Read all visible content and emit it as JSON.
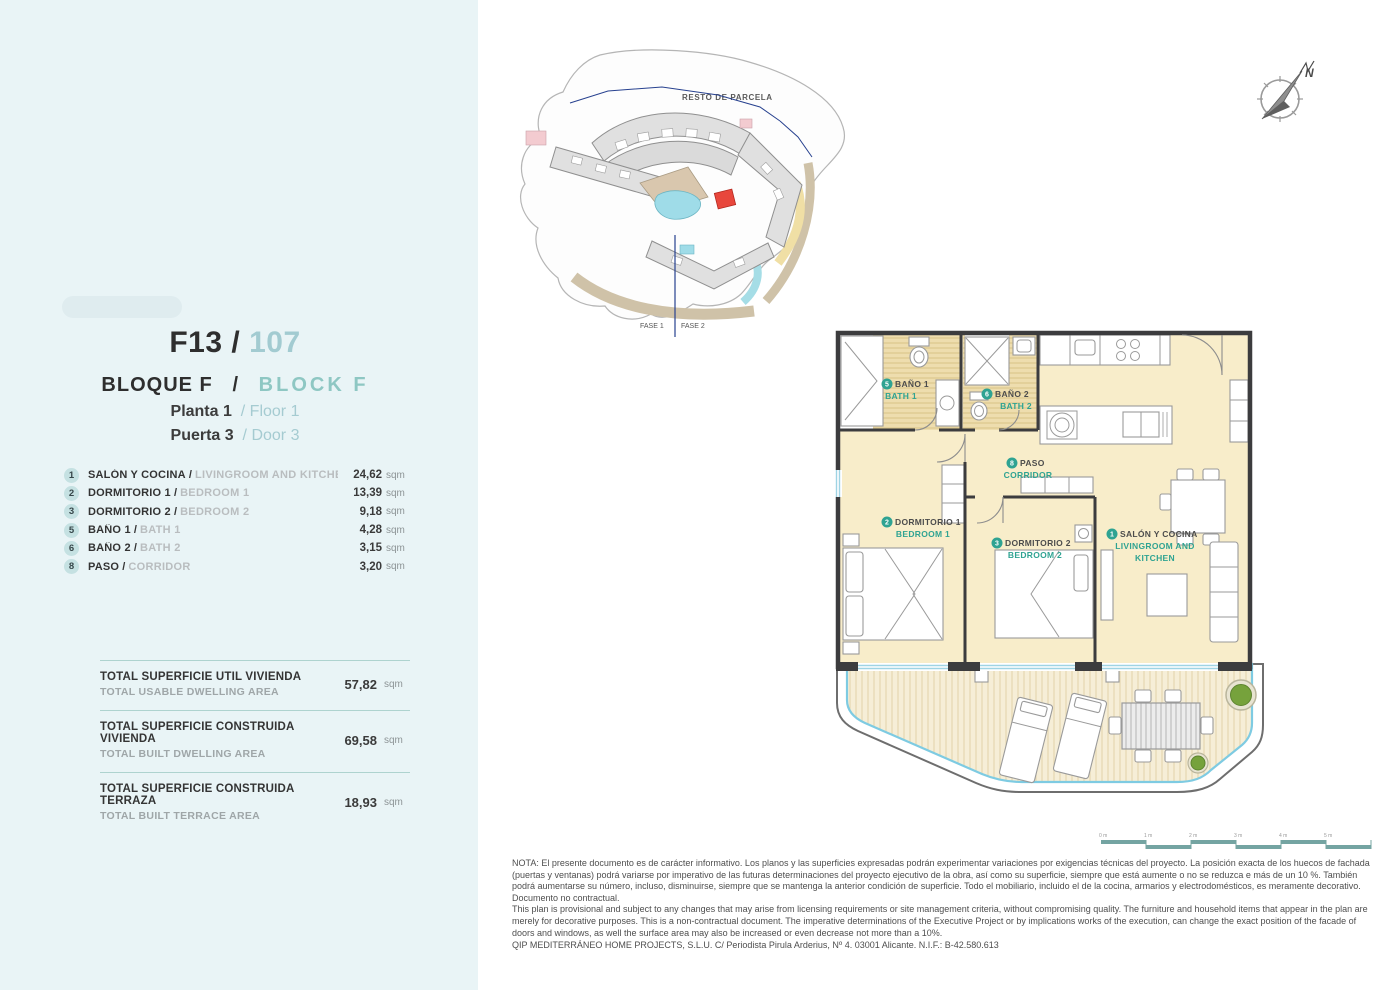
{
  "unit": {
    "code": "F13",
    "sep": "/",
    "number": "107",
    "block_es": "BLOQUE F",
    "block_en": "BLOCK F",
    "floor_es": "Planta 1",
    "floor_en": "Floor 1",
    "door_es": "Puerta 3",
    "door_en": "Door 3"
  },
  "rooms": {
    "sep": "/",
    "items": [
      {
        "num": "1",
        "name_es": "SALÓN Y COCINA",
        "name_en": "LIVINGROOM AND KITCHEN",
        "area": "24,62",
        "unit": "sqm"
      },
      {
        "num": "2",
        "name_es": "DORMITORIO 1",
        "name_en": "BEDROOM 1",
        "area": "13,39",
        "unit": "sqm"
      },
      {
        "num": "3",
        "name_es": "DORMITORIO 2",
        "name_en": "BEDROOM 2",
        "area": "9,18",
        "unit": "sqm"
      },
      {
        "num": "5",
        "name_es": "BAÑO 1",
        "name_en": "BATH 1",
        "area": "4,28",
        "unit": "sqm"
      },
      {
        "num": "6",
        "name_es": "BAÑO 2",
        "name_en": "BATH 2",
        "area": "3,15",
        "unit": "sqm"
      },
      {
        "num": "8",
        "name_es": "PASO",
        "name_en": "CORRIDOR",
        "area": "3,20",
        "unit": "sqm"
      }
    ]
  },
  "totals": [
    {
      "label_es": "TOTAL SUPERFICIE UTIL VIVIENDA",
      "label_en": "TOTAL USABLE DWELLING AREA",
      "value": "57,82",
      "unit": "sqm"
    },
    {
      "label_es": "TOTAL SUPERFICIE CONSTRUIDA VIVIENDA",
      "label_en": "TOTAL BUILT DWELLING AREA",
      "value": "69,58",
      "unit": "sqm"
    },
    {
      "label_es": "TOTAL SUPERFICIE CONSTRUIDA TERRAZA",
      "label_en": "TOTAL BUILT TERRACE AREA",
      "value": "18,93",
      "unit": "sqm"
    }
  ],
  "site_plan": {
    "resto_label": "RESTO DE PARCELA",
    "fase1": "FASE 1",
    "fase2": "FASE 2"
  },
  "compass": {
    "north_label": "N"
  },
  "plan": {
    "labels": [
      {
        "num": "5",
        "es": "BAÑO 1",
        "en_line1": "BATH 1"
      },
      {
        "num": "6",
        "es": "BAÑO 2",
        "en_line1": "BATH 2"
      },
      {
        "num": "8",
        "es": "PASO",
        "en_line1": "CORRIDOR"
      },
      {
        "num": "2",
        "es": "DORMITORIO 1",
        "en_line1": "BEDROOM 1"
      },
      {
        "num": "3",
        "es": "DORMITORIO 2",
        "en_line1": "BEDROOM 2"
      },
      {
        "num": "1",
        "es": "SALÓN Y COCINA",
        "en_line1": "LIVINGROOM AND",
        "en_line2": "KITCHEN"
      }
    ],
    "scale_labels": [
      "0 m",
      "1 m",
      "2 m",
      "3 m",
      "4 m",
      "5 m"
    ]
  },
  "legal": {
    "note_es": "NOTA: El presente documento es de carácter informativo. Los planos y las superficies expresadas podrán experimentar variaciones por exigencias técnicas del proyecto. La posición exacta de los huecos de fachada (puertas y ventanas) podrá variarse por imperativo de las futuras determinaciones del proyecto ejecutivo de la obra, así como su superficie, siempre que está aumente o no se reduzca e más de un 10 %. También podrá aumentarse su número, incluso, disminuirse, siempre que se mantenga la anterior condición de superficie. Todo el mobiliario, incluido el de la cocina, armarios y electrodomésticos, es meramente decorativo. Documento no contractual.",
    "note_en": "This plan is provisional and subject to any changes that may arise from licensing requirements or site management criteria, without compromising quality. The furniture and household items that appear in the plan are merely for decorative purposes. This is a non-contractual document. The imperative determinations of the Executive Project or by implications works of the execution, can change the exact position of the facade of doors and windows, as well the surface area may also be increased or even decrease not more than a 10%.",
    "company": "QIP MEDITERRÁNEO HOME PROJECTS, S.L.U. C/ Periodista Pirula Arderius, Nº 4. 03001 Alicante. N.I.F.: B-42.580.613"
  },
  "colors": {
    "sidebar_bg": "#e9f4f6",
    "accent_teal": "#2fa392",
    "light_teal": "#8ec7c3",
    "badge_bg": "#c5e1e2",
    "wall": "#3c3c3e",
    "room_floor": "#f8edca",
    "bath_floor": "#eeddae",
    "terrace_floor": "#f6eed7",
    "railing_blue": "#7ecbe2",
    "highlight_red": "#e8473c",
    "plant_green": "#76a23c"
  }
}
